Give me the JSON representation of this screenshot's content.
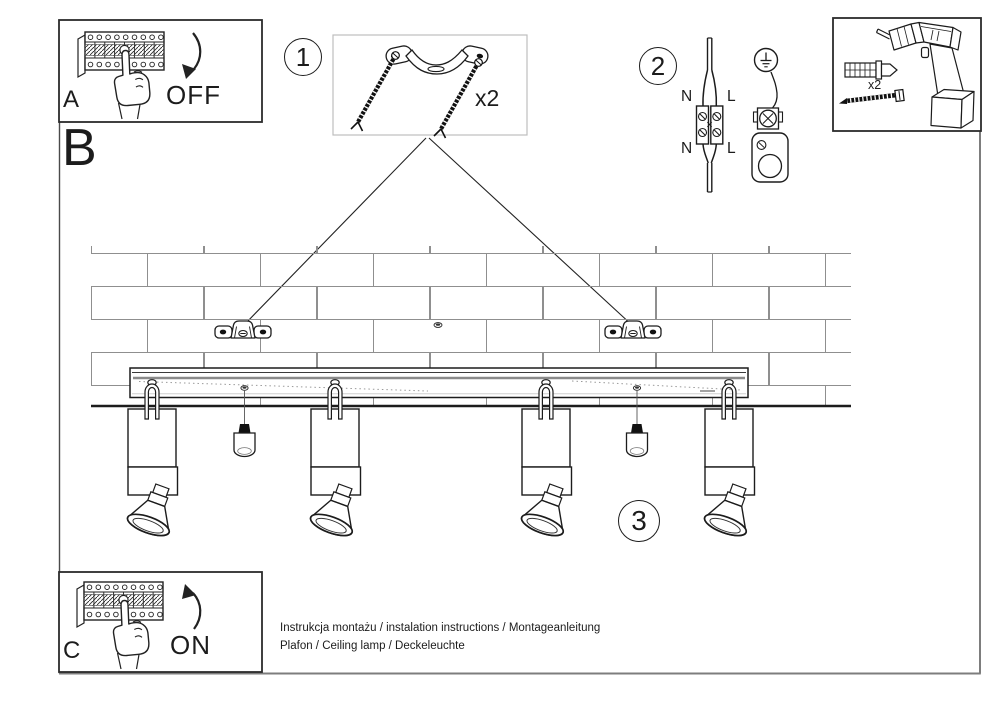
{
  "colors": {
    "ink": "#1c1c1c",
    "frame_gray": "#7d7d7d",
    "light_box_border": "#bdbdbd",
    "mortar_gray": "#8f8f8f"
  },
  "sections": {
    "a": {
      "label": "A",
      "action": "OFF"
    },
    "b": {
      "label": "B"
    },
    "c": {
      "label": "C",
      "action": "ON"
    }
  },
  "steps": {
    "one": {
      "number": "1",
      "quantity": "x2"
    },
    "two": {
      "number": "2",
      "wire_labels": {
        "n_top": "N",
        "l_top": "L",
        "n_bottom": "N",
        "l_bottom": "L"
      }
    },
    "three": {
      "number": "3"
    }
  },
  "tools": {
    "quantity": "x2"
  },
  "footer": {
    "line1": "Instrukcja montażu / instalation instructions / Montageanleitung",
    "line2": "Plafon / Ceiling lamp / Deckeleuchte"
  },
  "icons": [
    "breaker-panel-icon",
    "pointing-hand-icon",
    "curved-arrow-down-icon",
    "curved-arrow-up-icon",
    "mounting-bracket-icon",
    "mounting-screw-icon",
    "terminal-block-icon",
    "earth-ground-icon",
    "ground-clamp-icon",
    "power-drill-icon",
    "wall-plug-icon",
    "wood-screw-icon",
    "brick-wall-icon",
    "ceiling-bar-icon",
    "spotlight-icon",
    "bulb-icon"
  ]
}
